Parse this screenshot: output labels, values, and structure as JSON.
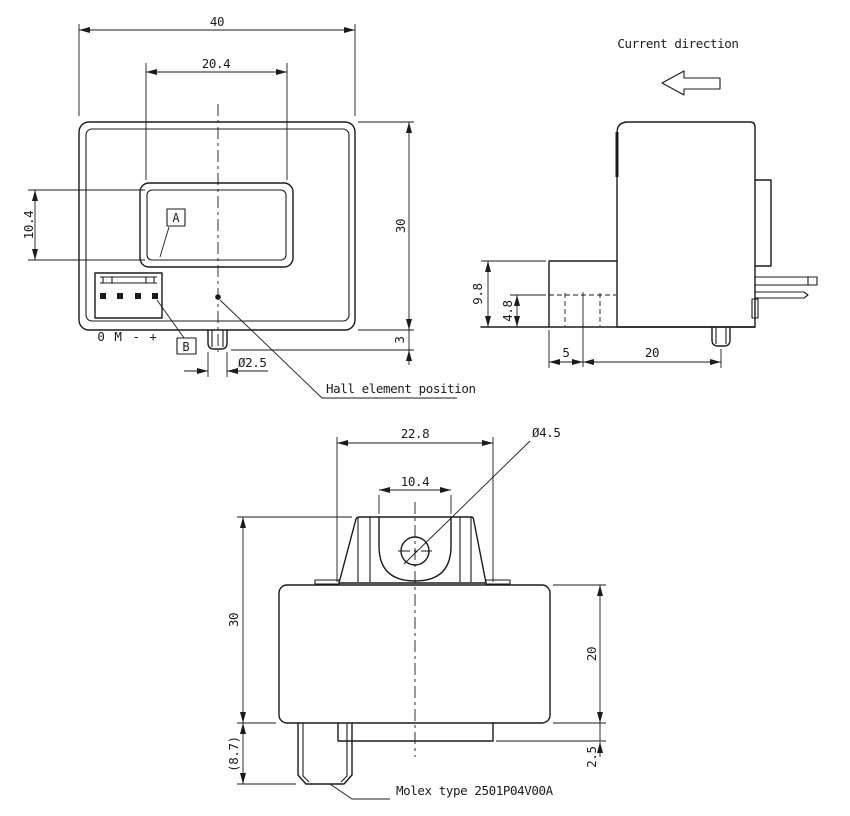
{
  "colors": {
    "line": "#1b1b1b",
    "background": "#ffffff"
  },
  "drawing": {
    "front_view": {
      "dim_overall_width": "40",
      "dim_window_width": "20.4",
      "dim_window_height": "10.4",
      "dim_overall_height": "30",
      "dim_pin_protrusion": "3",
      "dim_pin_diameter": "Ø2.5",
      "label_a": "A",
      "label_b": "B",
      "pin_labels": [
        "0",
        "M",
        "-",
        "+"
      ],
      "hall_annotation": "Hall element position"
    },
    "side_view": {
      "heading": "Current direction",
      "dim_connector_height": "9.8",
      "dim_pin_level": "4.8",
      "dim_connector_offset": "5",
      "dim_pin_position": "20"
    },
    "bottom_view": {
      "dim_bracket_width": "22.8",
      "dim_slot_width": "10.4",
      "dim_hole_diameter": "Ø4.5",
      "dim_body_height": "30",
      "dim_body_depth": "20",
      "dim_base_plate_thickness": "2.5",
      "dim_connector_depth": "(8.7)",
      "molex_annotation": "Molex type 2501P04V00A"
    }
  }
}
